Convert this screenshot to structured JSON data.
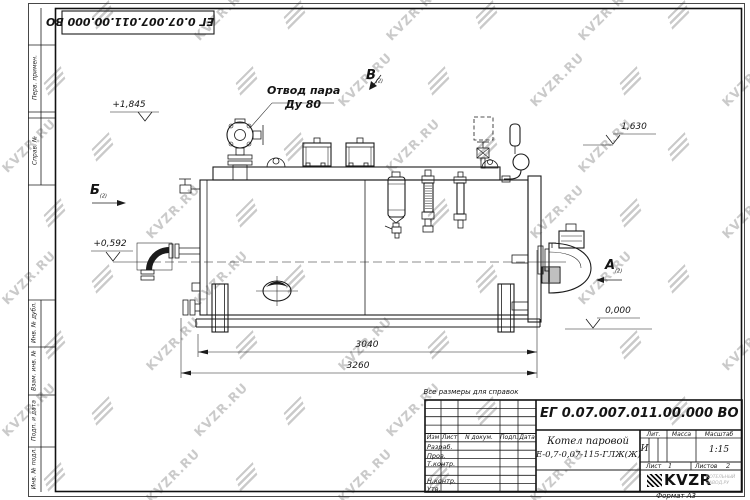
{
  "watermark": {
    "text": "KVZR.RU"
  },
  "corner_stamp": {
    "doc_number": "ЕГ 0.07.007.011.00.000  ВО"
  },
  "margin_labels": {
    "perv_primen": "Перв. примен.",
    "sprav_no": "Справ. №",
    "inv_dubl": "Инв. № дубл.",
    "vzam_inv": "Взам. инв. №",
    "podp_data": "Подп. и дата",
    "inv_podl": "Инв. № подл."
  },
  "drawing": {
    "note": "Все размеры для справок",
    "steam_label_line1": "Отвод пара",
    "steam_label_line2": "Ду 80",
    "dim_3040": "3040",
    "dim_3260": "3260",
    "elev_1845": "+1,845",
    "elev_1630": "1,630",
    "elev_0592": "+0,592",
    "elev_0000": "0,000",
    "view_a": "А",
    "view_b": "Б",
    "view_v": "В",
    "view_sheet_ref": "(2)"
  },
  "title_block": {
    "doc_number": "ЕГ 0.07.007.011.00.000  ВО",
    "product_line1": "Котел паровой",
    "product_line2": "Е-0,7-0,07-115-ГЛЖ(Ж)",
    "col_izm": "Изм",
    "col_list": "Лист",
    "col_ndokum": "N докум.",
    "col_podp": "Подп.",
    "col_data": "Дата",
    "row_razrab": "Разраб.",
    "row_prov": "Пров.",
    "row_tkontr": "Т.контр.",
    "row_nkontr": "Н.контр.",
    "row_utv": "Утв.",
    "lit_label": "Лит.",
    "mass_label": "Масса",
    "scale_label": "Масштаб",
    "lit_value": "И",
    "scale_value": "1:15",
    "sheet_label": "Лист",
    "sheet_value": "1",
    "sheets_label": "Листов",
    "sheets_value": "2",
    "logo_text": "KVZR",
    "logo_sub_line1": "КОТЕЛЬНЫЙ",
    "logo_sub_line2": "ЗАВОД.РУ",
    "format_label": "Формат А3"
  }
}
